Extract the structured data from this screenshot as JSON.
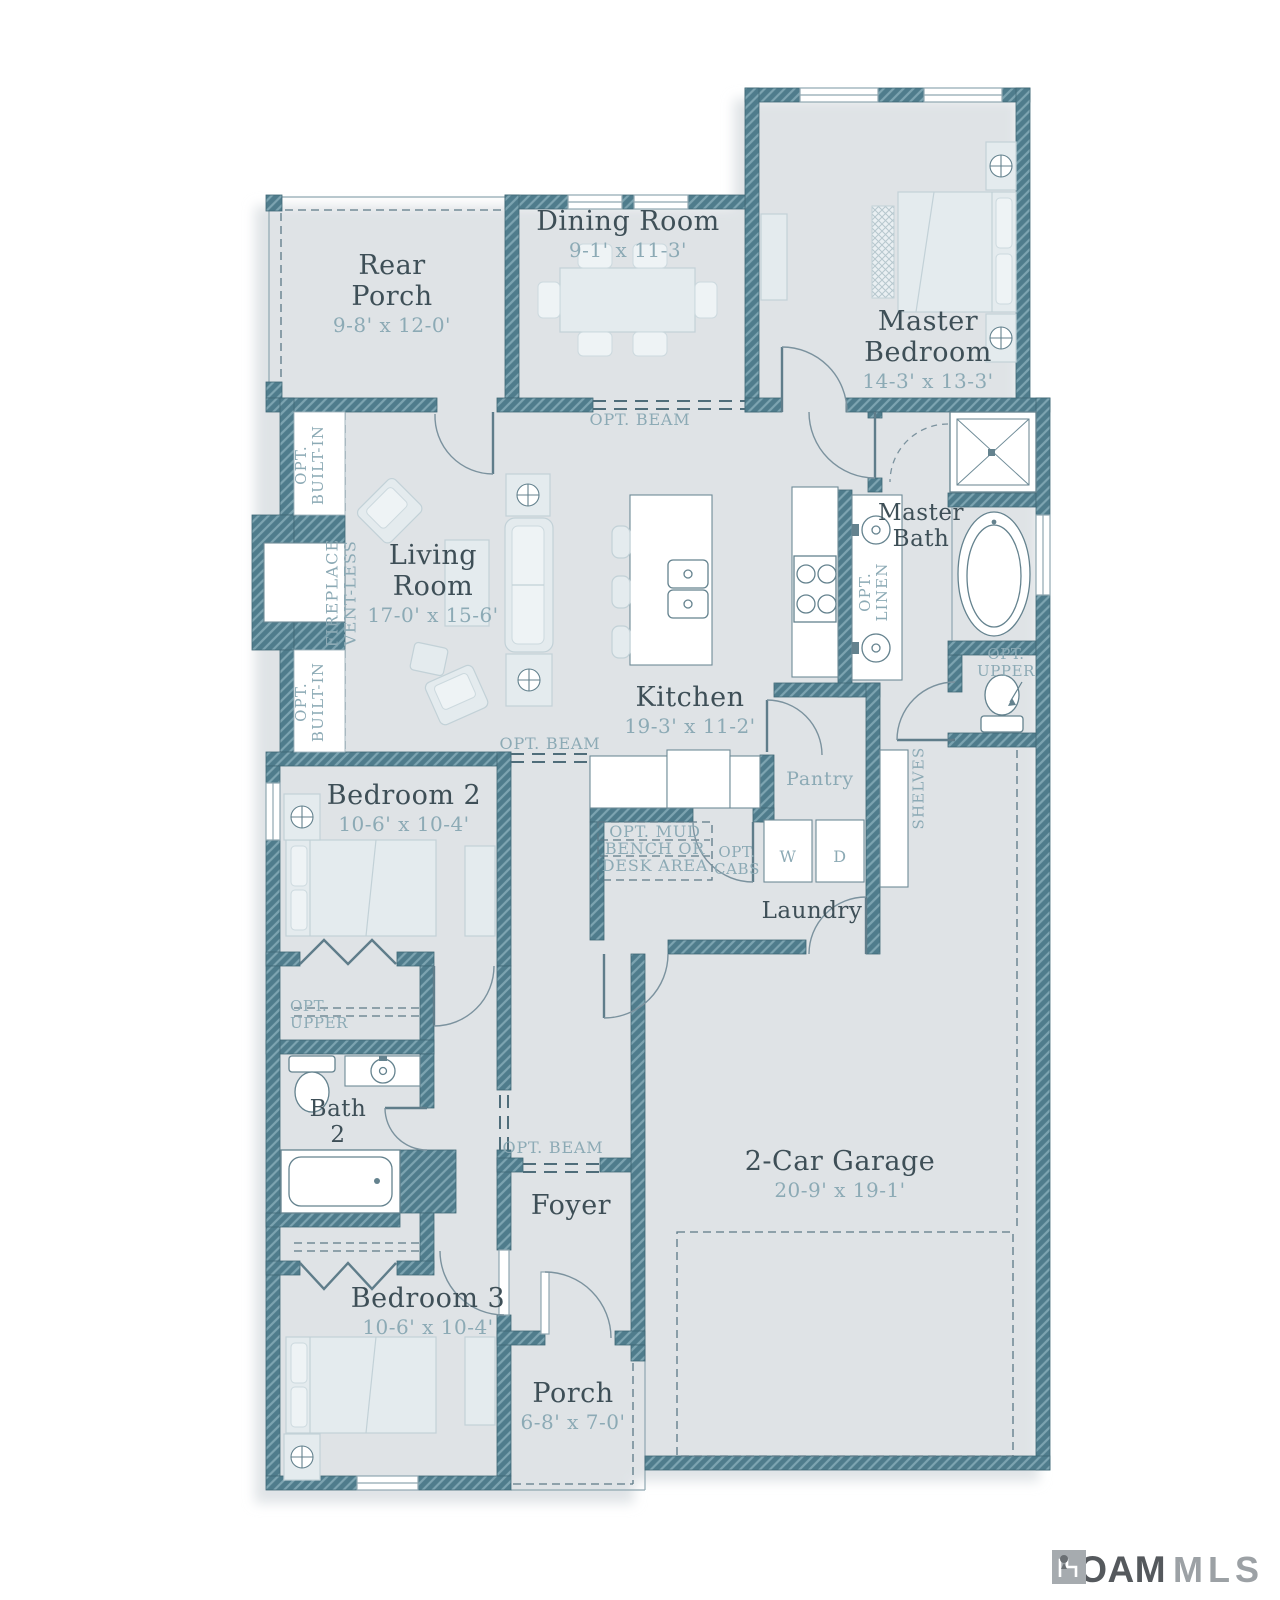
{
  "rooms": {
    "rear_porch": {
      "line1": "Rear",
      "line2": "Porch",
      "dims": "9-8' x 12-0'"
    },
    "dining_room": {
      "name": "Dining Room",
      "dims": "9-1' x 11-3'"
    },
    "master_bedroom": {
      "line1": "Master",
      "line2": "Bedroom",
      "dims": "14-3' x 13-3'"
    },
    "living_room": {
      "line1": "Living",
      "line2": "Room",
      "dims": "17-0' x 15-6'"
    },
    "kitchen": {
      "name": "Kitchen",
      "dims": "19-3' x 11-2'"
    },
    "master_bath": {
      "line1": "Master",
      "line2": "Bath"
    },
    "bedroom_2": {
      "name": "Bedroom 2",
      "dims": "10-6' x 10-4'"
    },
    "laundry": {
      "name": "Laundry"
    },
    "pantry": {
      "name": "Pantry"
    },
    "bath_2": {
      "line1": "Bath",
      "line2": "2"
    },
    "foyer": {
      "name": "Foyer"
    },
    "bedroom_3": {
      "name": "Bedroom 3",
      "dims": "10-6' x 10-4'"
    },
    "porch": {
      "name": "Porch",
      "dims": "6-8' x 7-0'"
    },
    "garage": {
      "name": "2-Car Garage",
      "dims": "20-9' x 19-1'"
    }
  },
  "annotations": {
    "opt_beam": "OPT. BEAM",
    "opt": "OPT.",
    "built_in": "BUILT-IN",
    "fireplace": "FIREPLACE",
    "vent_less": "VENT-LESS",
    "linen": "LINEN",
    "shelves": "SHELVES",
    "upper": "UPPER",
    "mud_line1": "OPT. MUD",
    "mud_line2": "BENCH OR",
    "mud_line3": "DESK AREA",
    "cabs": "CABS",
    "washer": "W",
    "dryer": "D"
  },
  "logo": {
    "brand": "ROAM",
    "suffix": "MLS"
  },
  "colors": {
    "wall": "#4f7c8c",
    "wall_stripe": "#7da4b1",
    "label_text": "#3e4f57",
    "dimension_text": "#8caab5",
    "furniture_fill": "#e4ebee",
    "shadow": "#dfe3e6"
  }
}
